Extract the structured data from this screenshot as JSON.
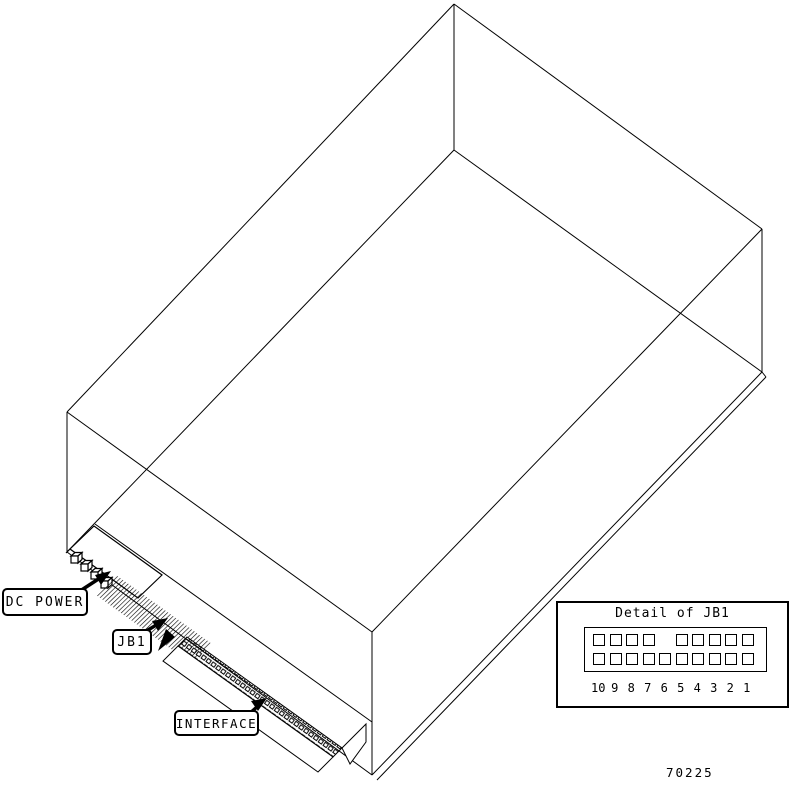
{
  "diagram": {
    "callouts": {
      "dc_power": "DC POWER",
      "jb1": "JB1",
      "interface": "INTERFACE"
    },
    "figure_number": "70225"
  },
  "detail_of_jb1": {
    "title": "Detail of JB1",
    "pin_columns": [
      {
        "number": "10",
        "top": true,
        "bottom": true
      },
      {
        "number": "9",
        "top": true,
        "bottom": true
      },
      {
        "number": "8",
        "top": true,
        "bottom": true
      },
      {
        "number": "7",
        "top": true,
        "bottom": true
      },
      {
        "number": "6",
        "top": false,
        "bottom": true
      },
      {
        "number": "5",
        "top": true,
        "bottom": true
      },
      {
        "number": "4",
        "top": true,
        "bottom": true
      },
      {
        "number": "3",
        "top": true,
        "bottom": true
      },
      {
        "number": "2",
        "top": true,
        "bottom": true
      },
      {
        "number": "1",
        "top": true,
        "bottom": true
      }
    ]
  },
  "colors": {
    "line": "#000000",
    "background": "#ffffff"
  }
}
